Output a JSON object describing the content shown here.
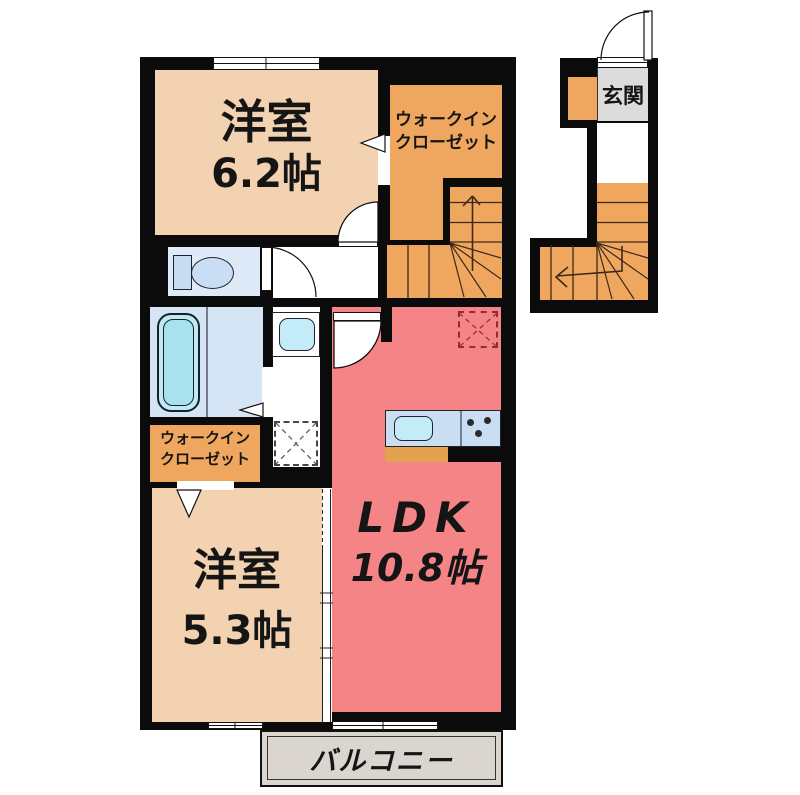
{
  "rooms": {
    "bedroom_upper": {
      "name": "洋室",
      "size": "6.2帖"
    },
    "wic_upper": {
      "line1": "ウォークイン",
      "line2": "クローゼット"
    },
    "bedroom_lower": {
      "name": "洋室",
      "size": "5.3帖"
    },
    "wic_lower": {
      "line1": "ウォークイン",
      "line2": "クローゼット"
    },
    "ldk": {
      "name": "LDK",
      "size": "10.8帖"
    },
    "entrance": {
      "name": "玄関"
    },
    "balcony": {
      "name": "バルコニー"
    }
  },
  "palette": {
    "wall": "#0B0B0B",
    "room_peach": "#F2D2B0",
    "closet_orange": "#EFA75F",
    "ldk_red": "#F58487",
    "toilet_blue": "#DEEAF8",
    "bath_blue": "#D5E5F5",
    "tub_cyan": "#A9E2EF",
    "counter_blue": "#C9DEF2",
    "sink_cyan": "#C3ECF8",
    "entry_gray": "#DCDCDC",
    "balcony_gray": "#DAD5CF",
    "kitchen_base_orange": "#E2A24E",
    "fridge_dash": "#8D2F2F",
    "stair_line": "#3D2817"
  },
  "icons": {
    "toilet": "toilet-icon",
    "bathtub": "bathtub-icon",
    "vanity_sink": "vanity-sink-icon",
    "washing_machine": "washing-machine-space-icon",
    "kitchen_sink": "kitchen-sink-icon",
    "stove": "gas-stove-icon",
    "refrigerator": "refrigerator-space-icon"
  }
}
